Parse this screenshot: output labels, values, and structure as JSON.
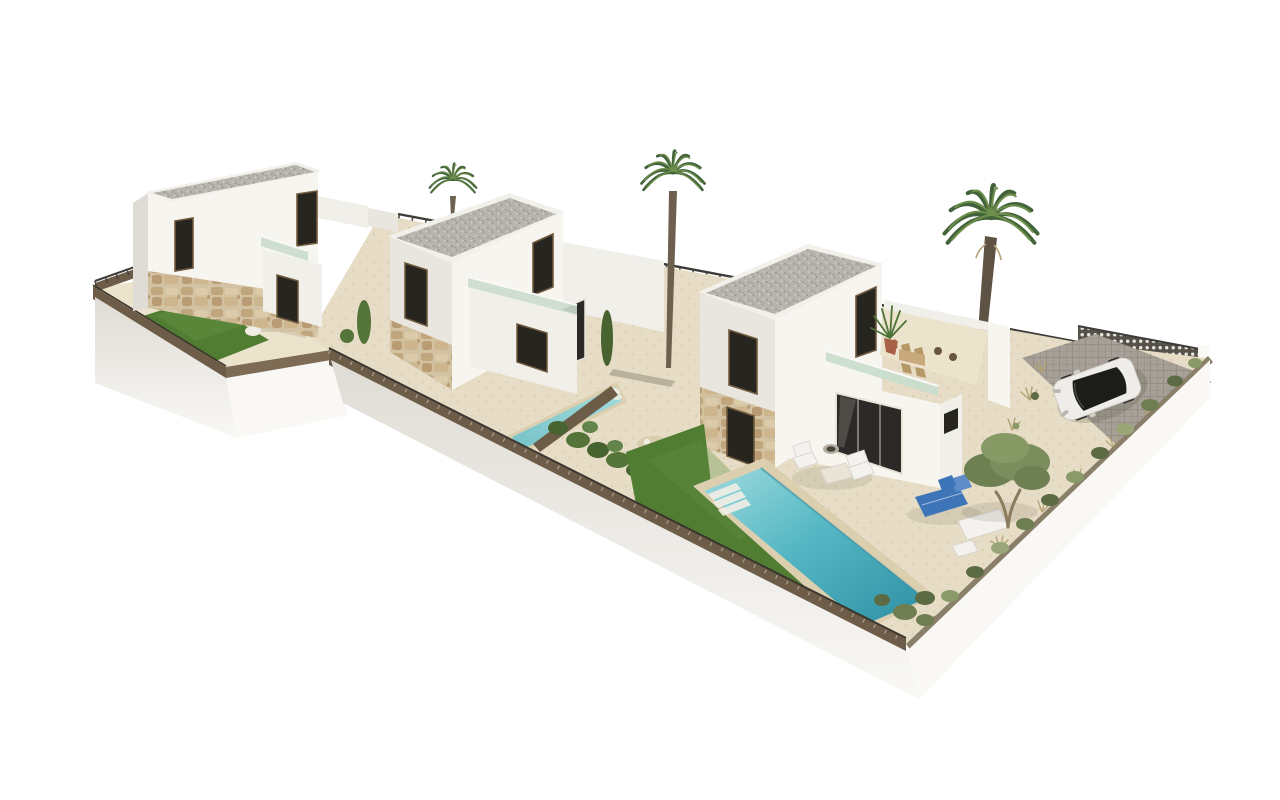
{
  "scene": {
    "title": "3D render — three modern villas with pools",
    "description": "Aerial 3D architectural rendering on a white background: three white two-storey villas with stone-clad bases and flat gravel roofs arranged diagonally on a raised plot, each with a private turquoise pool, artificial lawn, beige terraces, glass balustrades, roof terrace with outdoor furniture, three palm trees, an olive tree, sun loungers, perimeter stone fences with dark railings, a breeze-block wall and a white SUV parked on a grey paved driveway."
  },
  "objects": {
    "villas": 3,
    "pools": 3,
    "palm_trees": 3,
    "olive_trees": 1,
    "cars": 1,
    "sun_loungers": 2,
    "roof_terraces": 3,
    "lawns": 3
  },
  "palette": {
    "bg": "#ffffff",
    "wall_bright": "#f7f5f0",
    "wall_light": "#f1efe9",
    "wall_shade": "#e9e6e0",
    "wall_deep": "#dfdcd5",
    "roof_edge": "#f2f0ea",
    "gravel_base": "#b7b4ad",
    "gravel_dot_dark": "#95928c",
    "gravel_dot_light": "#d9d7d2",
    "stone_base": "#d2c2a1",
    "stone_a": "#c0a67c",
    "stone_b": "#dbcba9",
    "stone_c": "#b99c73",
    "stone_d": "#cdb68e",
    "paving": "#e7ddc6",
    "paving_light": "#ece3cd",
    "sand_dot": "#cfc2a3",
    "lawn": "#517d33",
    "lawn_light": "#629040",
    "fence_brown": "#6d5c47",
    "fence_brown_lit": "#7d6b54",
    "fence_rail": "#3a362e",
    "railing_dark": "#3d3c38",
    "wall_band": "#e2e0da",
    "lattice_base": "#56524a",
    "lattice_dot": "#e8e6df",
    "plinth_front": "#ebeae6",
    "plinth_lit": "#f9f8f5",
    "hedge_base": "#8a7f68",
    "bush_dark": "#47632f",
    "bush_mid": "#557439",
    "bush_light": "#63844a",
    "hedge_a": "#6e7e50",
    "hedge_b": "#8a9a68",
    "hedge_c": "#5c6b44",
    "hedge_d": "#9aa678",
    "glass_green": "#c9dccc",
    "glass_dark": "#26251f",
    "door_dark": "#2b2a26",
    "frame_brown": "#6f5a3d",
    "frame_white": "#e8e4da",
    "pool_rim": "#dccfb0",
    "pool2_a": "#a5dcdc",
    "pool2_b": "#74c2c8",
    "pool3_a": "#9edade",
    "pool3_b": "#56b8c4",
    "pool3_c": "#2f8fa4",
    "steps_white": "#f2efe6",
    "white_furn": "#f3f2ee",
    "furn_stroke": "#d5d2ca",
    "table_beige": "#eae4d6",
    "lounger_blue": "#3e74b8",
    "lounger_blue_light": "#5d8cc9",
    "wood_tan": "#c8a97c",
    "wood_tan_dark": "#b69867",
    "pot_terracotta": "#a86047",
    "plant_green": "#4d7438",
    "stool_brown": "#6a563f",
    "palm_dark": "#43633a",
    "palm_light": "#6f8f4c",
    "trunk": "#6e604e",
    "trunk_dark": "#5d5243",
    "olive_a": "#6e8052",
    "olive_b": "#7b8d5c",
    "olive_c": "#879a66",
    "olive_trunk": "#8a7a5e",
    "driveway": "#a6a098",
    "paver_line": "#948e85",
    "drive_wall": "#5c5952",
    "car_body": "#efede9",
    "car_glass": "#1c1c1a",
    "car_detail": "#cfccc4",
    "shadow": "#55503f",
    "rock_brown": "#8a6a4a",
    "rock_white": "#f1ede4",
    "dry_grass": "#b3a375",
    "dirt_patch": "#d9cdad"
  }
}
